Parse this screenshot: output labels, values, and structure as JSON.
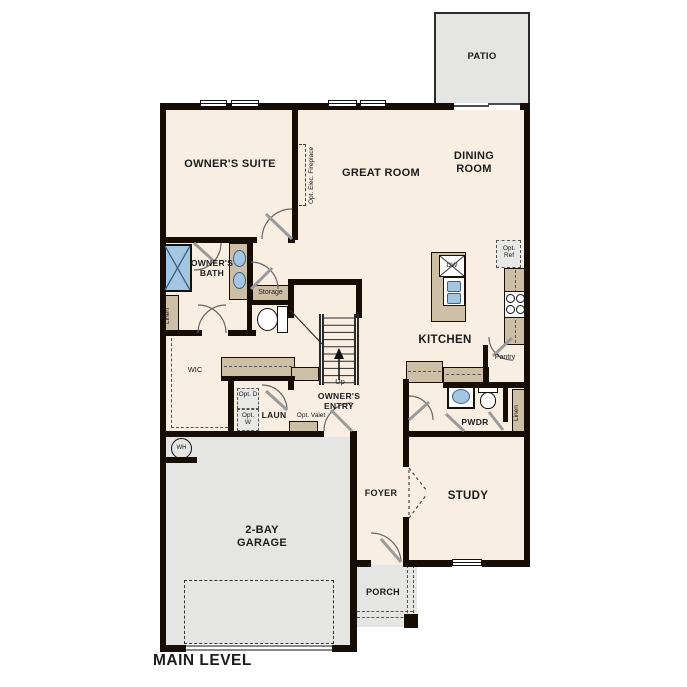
{
  "plan_title": "MAIN LEVEL",
  "rooms": {
    "patio": "PATIO",
    "owners_suite": "OWNER'S SUITE",
    "great_room": "GREAT ROOM",
    "dining_room": "DINING ROOM",
    "owners_bath": "OWNER'S BATH",
    "storage": "Storage",
    "linen_hall": "Linen",
    "wic": "WIC",
    "kitchen": "KITCHEN",
    "pantry": "Pantry",
    "laundry": "LAUN",
    "owners_entry": "OWNER'S ENTRY",
    "pwdr": "PWDR",
    "linen_pwdr": "Linen",
    "foyer": "FOYER",
    "study": "STUDY",
    "garage": "2-BAY GARAGE",
    "porch": "PORCH"
  },
  "annotations": {
    "opt_elec_fireplace": "Opt. Elec. Fireplace",
    "opt_ref": "Opt. Ref",
    "opt_dryer": "Opt. D",
    "opt_washer": "Opt. W",
    "opt_valet": "Opt. Valet",
    "stairs_up": "Up",
    "dishwasher": "DW",
    "water_heater": "WH"
  },
  "colors": {
    "interior_floor": "#f8efe2",
    "exterior_floor": "#e5e5e3",
    "cabinetry": "#ccbfa6",
    "fixture_blue": "#a3c7e3",
    "wall": "#150d06"
  }
}
